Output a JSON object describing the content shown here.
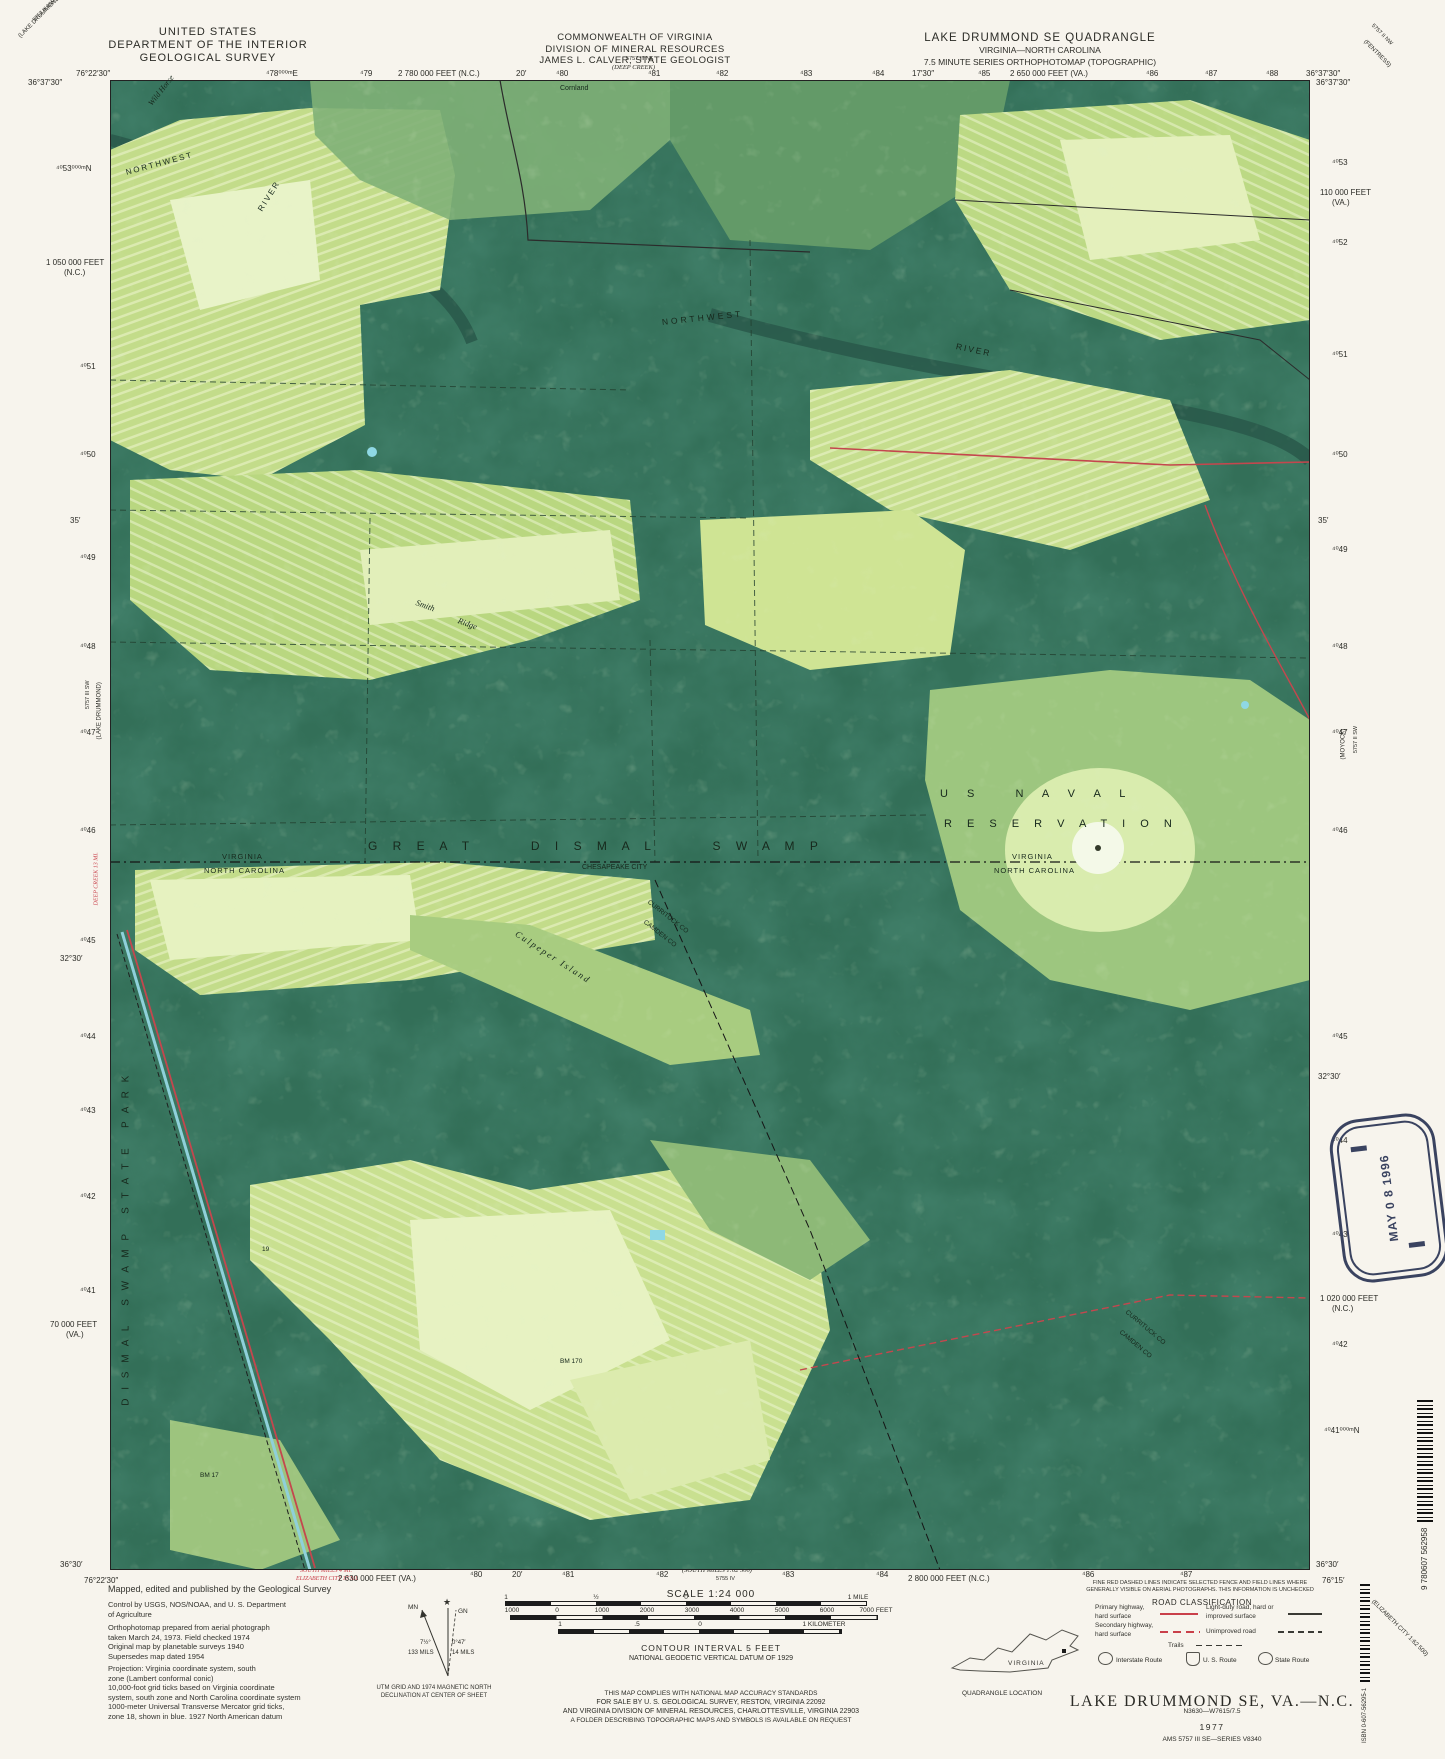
{
  "header": {
    "agency_lines": [
      "UNITED STATES",
      "DEPARTMENT OF THE INTERIOR",
      "GEOLOGICAL SURVEY"
    ],
    "state_lines": [
      "COMMONWEALTH OF VIRGINIA",
      "DIVISION OF MINERAL RESOURCES",
      "JAMES L. CALVER, STATE GEOLOGIST"
    ],
    "quad_lines": [
      "LAKE DRUMMOND SE QUADRANGLE",
      "VIRGINIA—NORTH CAROLINA",
      "7.5 MINUTE SERIES ORTHOPHOTOMAP (TOPOGRAPHIC)"
    ]
  },
  "margin_ticks": {
    "top": [
      {
        "t": "76°22′30″",
        "x": 76,
        "y": 69
      },
      {
        "t": "⁴78⁰⁰⁰ᵐE",
        "x": 266,
        "y": 69
      },
      {
        "t": "⁴79",
        "x": 360,
        "y": 69
      },
      {
        "t": "2 780 000 FEET (N.C.)",
        "x": 398,
        "y": 69
      },
      {
        "t": "20′",
        "x": 516,
        "y": 69
      },
      {
        "t": "⁴80",
        "x": 556,
        "y": 69
      },
      {
        "t": "⁴81",
        "x": 648,
        "y": 69
      },
      {
        "t": "⁴82",
        "x": 716,
        "y": 69
      },
      {
        "t": "⁴83",
        "x": 800,
        "y": 69
      },
      {
        "t": "⁴84",
        "x": 872,
        "y": 69
      },
      {
        "t": "17′30″",
        "x": 912,
        "y": 69
      },
      {
        "t": "⁴85",
        "x": 978,
        "y": 69
      },
      {
        "t": "2 650 000 FEET (VA.)",
        "x": 1010,
        "y": 69
      },
      {
        "t": "⁴86",
        "x": 1146,
        "y": 69
      },
      {
        "t": "⁴87",
        "x": 1205,
        "y": 69
      },
      {
        "t": "⁴88",
        "x": 1266,
        "y": 69
      },
      {
        "t": "36°37′30″",
        "x": 1306,
        "y": 69
      }
    ],
    "left": [
      {
        "t": "36°37′30″",
        "x": 28,
        "y": 78
      },
      {
        "t": "⁴⁰53⁰⁰⁰ᵐN",
        "x": 56,
        "y": 164
      },
      {
        "t": "1 050 000 FEET",
        "x": 46,
        "y": 258
      },
      {
        "t": "(N.C.)",
        "x": 64,
        "y": 268
      },
      {
        "t": "⁴⁰51",
        "x": 80,
        "y": 362
      },
      {
        "t": "⁴⁰50",
        "x": 80,
        "y": 450
      },
      {
        "t": "35′",
        "x": 70,
        "y": 516
      },
      {
        "t": "⁴⁰49",
        "x": 80,
        "y": 553
      },
      {
        "t": "⁴⁰48",
        "x": 80,
        "y": 642
      },
      {
        "t": "⁴⁰47",
        "x": 80,
        "y": 728
      },
      {
        "t": "⁴⁰46",
        "x": 80,
        "y": 826
      },
      {
        "t": "⁴⁰45",
        "x": 80,
        "y": 936
      },
      {
        "t": "32°30′",
        "x": 60,
        "y": 954
      },
      {
        "t": "⁴⁰44",
        "x": 80,
        "y": 1032
      },
      {
        "t": "⁴⁰43",
        "x": 80,
        "y": 1106
      },
      {
        "t": "⁴⁰42",
        "x": 80,
        "y": 1192
      },
      {
        "t": "⁴⁰41",
        "x": 80,
        "y": 1286
      },
      {
        "t": "70 000 FEET",
        "x": 50,
        "y": 1320
      },
      {
        "t": "(VA.)",
        "x": 66,
        "y": 1330
      },
      {
        "t": "36°30′",
        "x": 60,
        "y": 1560
      }
    ],
    "right": [
      {
        "t": "36°37′30″",
        "x": 1316,
        "y": 78
      },
      {
        "t": "⁴⁰53",
        "x": 1332,
        "y": 158
      },
      {
        "t": "110 000 FEET",
        "x": 1320,
        "y": 188
      },
      {
        "t": "(VA.)",
        "x": 1332,
        "y": 198
      },
      {
        "t": "⁴⁰52",
        "x": 1332,
        "y": 238
      },
      {
        "t": "⁴⁰51",
        "x": 1332,
        "y": 350
      },
      {
        "t": "⁴⁰50",
        "x": 1332,
        "y": 450
      },
      {
        "t": "35′",
        "x": 1318,
        "y": 516
      },
      {
        "t": "⁴⁰49",
        "x": 1332,
        "y": 545
      },
      {
        "t": "⁴⁰48",
        "x": 1332,
        "y": 642
      },
      {
        "t": "⁴⁰47",
        "x": 1332,
        "y": 728
      },
      {
        "t": "⁴⁰46",
        "x": 1332,
        "y": 826
      },
      {
        "t": "⁴⁰45",
        "x": 1332,
        "y": 1032
      },
      {
        "t": "32°30′",
        "x": 1318,
        "y": 1072
      },
      {
        "t": "⁴⁰44",
        "x": 1332,
        "y": 1136
      },
      {
        "t": "⁴⁰43",
        "x": 1332,
        "y": 1230
      },
      {
        "t": "1 020 000 FEET",
        "x": 1320,
        "y": 1294
      },
      {
        "t": "(N.C.)",
        "x": 1332,
        "y": 1304
      },
      {
        "t": "⁴⁰42",
        "x": 1332,
        "y": 1340
      },
      {
        "t": "⁴⁰41⁰⁰⁰ᵐN",
        "x": 1324,
        "y": 1426
      },
      {
        "t": "36°30′",
        "x": 1316,
        "y": 1560
      }
    ],
    "bottom": [
      {
        "t": "76°22′30″",
        "x": 84,
        "y": 1576
      },
      {
        "t": "SOUTH MILLS 4 MI.",
        "x": 300,
        "y": 1568,
        "cls": "red ital",
        "size": 6
      },
      {
        "t": "ELIZABETH CITY 17 MI.",
        "x": 296,
        "y": 1576,
        "cls": "red ital",
        "size": 6
      },
      {
        "t": "2 630 000 FEET (VA.)",
        "x": 338,
        "y": 1574
      },
      {
        "t": "⁴80",
        "x": 470,
        "y": 1570
      },
      {
        "t": "20′",
        "x": 512,
        "y": 1570
      },
      {
        "t": "⁴81",
        "x": 562,
        "y": 1570
      },
      {
        "t": "⁴82",
        "x": 656,
        "y": 1570
      },
      {
        "t": "(SOUTH MILLS 1:62 500)",
        "x": 682,
        "y": 1567,
        "cls": "ital",
        "size": 6.5
      },
      {
        "t": "5755 IV",
        "x": 716,
        "y": 1576,
        "size": 5.5
      },
      {
        "t": "⁴83",
        "x": 782,
        "y": 1570
      },
      {
        "t": "⁴84",
        "x": 876,
        "y": 1570
      },
      {
        "t": "2 800 000 FEET (N.C.)",
        "x": 908,
        "y": 1574
      },
      {
        "t": "⁴86",
        "x": 1082,
        "y": 1570
      },
      {
        "t": "⁴87",
        "x": 1180,
        "y": 1570
      },
      {
        "t": "76°15′",
        "x": 1322,
        "y": 1576
      }
    ],
    "misc": [
      {
        "t": "DEEP CREEK 13 MI.",
        "x": 97,
        "y": 902,
        "rot": -90,
        "cls": "red ital",
        "size": 6
      },
      {
        "t": "5757 III NW",
        "x": 34,
        "y": 18,
        "rot": -45,
        "size": 5.5
      },
      {
        "t": "(LAKE DRUMMOND NW)",
        "x": 20,
        "y": 34,
        "rot": -45,
        "size": 6
      },
      {
        "t": "5757 II NW",
        "x": 1372,
        "y": 22,
        "rot": 45,
        "size": 5.5
      },
      {
        "t": "(FENTRESS)",
        "x": 1364,
        "y": 38,
        "rot": 45,
        "size": 6
      },
      {
        "t": "5757 III SW",
        "x": 88,
        "y": 706,
        "rot": -90,
        "size": 5.5
      },
      {
        "t": "(LAKE DRUMMOND)",
        "x": 100,
        "y": 736,
        "rot": -90,
        "size": 6
      },
      {
        "t": "(MOYOCK)",
        "x": 1344,
        "y": 756,
        "rot": -90,
        "size": 6
      },
      {
        "t": "5757 II SW",
        "x": 1356,
        "y": 750,
        "rot": -90,
        "size": 5.5
      },
      {
        "t": "(ELIZABETH CITY 1:62 500)",
        "x": 1372,
        "y": 1598,
        "rot": 45,
        "size": 6
      },
      {
        "t": "5757 III NE",
        "x": 626,
        "y": 56,
        "size": 5.5
      },
      {
        "t": "(DEEP CREEK)",
        "x": 612,
        "y": 64,
        "cls": "ital",
        "size": 6.5
      }
    ]
  },
  "map": {
    "labels": [
      {
        "t": "Wild Horse",
        "x": 150,
        "y": 100,
        "rot": -52,
        "cls": "ital map-label",
        "size": 8
      },
      {
        "t": "Cornland",
        "x": 560,
        "y": 85,
        "cls": "map-label",
        "size": 7
      },
      {
        "t": "NORTHWEST",
        "x": 126,
        "y": 168,
        "rot": -15,
        "ls": 2,
        "cls": "map-label",
        "size": 8
      },
      {
        "t": "RIVER",
        "x": 260,
        "y": 206,
        "rot": -58,
        "ls": 2,
        "cls": "map-label",
        "size": 8
      },
      {
        "t": "NORTHWEST",
        "x": 662,
        "y": 318,
        "rot": -6,
        "ls": 3,
        "cls": "map-label",
        "size": 8.5
      },
      {
        "t": "RIVER",
        "x": 956,
        "y": 342,
        "rot": 12,
        "ls": 2,
        "cls": "map-label",
        "size": 8.5
      },
      {
        "t": "Smith",
        "x": 416,
        "y": 598,
        "rot": 20,
        "cls": "ital map-label",
        "size": 8.5
      },
      {
        "t": "Ridge",
        "x": 458,
        "y": 616,
        "rot": 20,
        "cls": "ital map-label",
        "size": 8.5
      },
      {
        "t": "G R E A T      D I S M A L      S W A M P",
        "x": 368,
        "y": 840,
        "ls": 6,
        "cls": "map-label",
        "size": 12
      },
      {
        "t": "VIRGINIA",
        "x": 222,
        "y": 853,
        "ls": 1,
        "cls": "map-label",
        "size": 7.5
      },
      {
        "t": "NORTH CAROLINA",
        "x": 204,
        "y": 867,
        "ls": 1,
        "cls": "map-label",
        "size": 7.5
      },
      {
        "t": "CHESAPEAKE CITY",
        "x": 582,
        "y": 864,
        "cls": "map-label",
        "size": 7
      },
      {
        "t": "VIRGINIA",
        "x": 1012,
        "y": 853,
        "ls": 1,
        "cls": "map-label",
        "size": 7.5
      },
      {
        "t": "NORTH CAROLINA",
        "x": 994,
        "y": 867,
        "ls": 1,
        "cls": "map-label",
        "size": 7.5
      },
      {
        "t": "CURRITUCK CO",
        "x": 648,
        "y": 898,
        "rot": 38,
        "cls": "map-label",
        "size": 6.5
      },
      {
        "t": "CAMDEN CO",
        "x": 644,
        "y": 918,
        "rot": 38,
        "cls": "map-label",
        "size": 6.5
      },
      {
        "t": "Culpeper Island",
        "x": 516,
        "y": 928,
        "rot": 33,
        "ls": 2,
        "cls": "ital map-label",
        "size": 9
      },
      {
        "t": "U S   N A V A L",
        "x": 940,
        "y": 788,
        "ls": 8,
        "cls": "map-label",
        "size": 11
      },
      {
        "t": "R E S E R V A T I O N",
        "x": 944,
        "y": 818,
        "ls": 6,
        "cls": "map-label",
        "size": 11
      },
      {
        "t": "D I S M A L   S W A M P   S T A T E   P A R K",
        "x": 126,
        "y": 1400,
        "rot": -90,
        "ls": 3,
        "cls": "map-label",
        "size": 10
      },
      {
        "t": "CURRITUCK CO",
        "x": 1126,
        "y": 1308,
        "rot": 40,
        "cls": "map-label",
        "size": 6.5
      },
      {
        "t": "CAMDEN CO",
        "x": 1120,
        "y": 1328,
        "rot": 40,
        "cls": "map-label",
        "size": 6.5
      },
      {
        "t": "BM 170",
        "x": 560,
        "y": 1358,
        "cls": "map-label",
        "size": 6.5
      },
      {
        "t": "BM 17",
        "x": 200,
        "y": 1472,
        "cls": "map-label",
        "size": 6.5
      },
      {
        "t": "19",
        "x": 262,
        "y": 1246,
        "cls": "map-label",
        "size": 6.5
      }
    ]
  },
  "footer": {
    "credits": {
      "p1": "Mapped, edited and published by the Geological Survey",
      "p2": "Control by USGS, NOS/NOAA, and U. S. Department\nof Agriculture",
      "p3": "Orthophotomap prepared from aerial photograph\ntaken March 24, 1973.   Field checked 1974\nOriginal map by planetable surveys 1940\nSupersedes map dated 1954",
      "p4": "Projection: Virginia coordinate system, south\nzone (Lambert conformal conic)\n10,000-foot grid ticks based on Virginia coordinate\nsystem, south zone and North Carolina coordinate system\n1000-meter Universal Transverse Mercator grid ticks,\nzone 18, shown in blue.   1927 North American datum"
    },
    "scale_label": "SCALE 1:24 000",
    "bar_labels": [
      {
        "t": "1",
        "x": 506,
        "y": 1594,
        "ctr": 1,
        "size": 6.5
      },
      {
        "t": "½",
        "x": 596,
        "y": 1594,
        "ctr": 1,
        "size": 6.5
      },
      {
        "t": "0",
        "x": 686,
        "y": 1594,
        "ctr": 1,
        "size": 6.5
      },
      {
        "t": "1 MILE",
        "x": 858,
        "y": 1594,
        "ctr": 1,
        "size": 6.5
      },
      {
        "t": "1000",
        "x": 512,
        "y": 1607,
        "ctr": 1,
        "size": 6.5
      },
      {
        "t": "0",
        "x": 557,
        "y": 1607,
        "ctr": 1,
        "size": 6.5
      },
      {
        "t": "1000",
        "x": 602,
        "y": 1607,
        "ctr": 1,
        "size": 6.5
      },
      {
        "t": "2000",
        "x": 647,
        "y": 1607,
        "ctr": 1,
        "size": 6.5
      },
      {
        "t": "3000",
        "x": 692,
        "y": 1607,
        "ctr": 1,
        "size": 6.5
      },
      {
        "t": "4000",
        "x": 737,
        "y": 1607,
        "ctr": 1,
        "size": 6.5
      },
      {
        "t": "5000",
        "x": 782,
        "y": 1607,
        "ctr": 1,
        "size": 6.5
      },
      {
        "t": "6000",
        "x": 827,
        "y": 1607,
        "ctr": 1,
        "size": 6.5
      },
      {
        "t": "7000 FEET",
        "x": 876,
        "y": 1607,
        "ctr": 1,
        "size": 6.5
      },
      {
        "t": "1",
        "x": 560,
        "y": 1621,
        "ctr": 1,
        "size": 6.5
      },
      {
        "t": ".5",
        "x": 637,
        "y": 1621,
        "ctr": 1,
        "size": 6.5
      },
      {
        "t": "0",
        "x": 700,
        "y": 1621,
        "ctr": 1,
        "size": 6.5
      },
      {
        "t": "1 KILOMETER",
        "x": 824,
        "y": 1621,
        "ctr": 1,
        "size": 6.5
      }
    ],
    "contour": "CONTOUR INTERVAL 5 FEET",
    "datum": "NATIONAL GEODETIC VERTICAL DATUM OF 1929",
    "accuracy": [
      "THIS MAP COMPLIES WITH NATIONAL MAP ACCURACY STANDARDS",
      "FOR SALE BY U. S. GEOLOGICAL SURVEY, RESTON, VIRGINIA 22092",
      "AND VIRGINIA DIVISION OF MINERAL RESOURCES, CHARLOTTESVILLE, VIRGINIA 22903",
      "A FOLDER DESCRIBING TOPOGRAPHIC MAPS AND SYMBOLS IS AVAILABLE ON REQUEST"
    ],
    "declination": {
      "mn": "MN",
      "gn": "GN",
      "deg1": "7½°",
      "mils1": "133 MILS",
      "deg2": "0°47′",
      "mils2": "14 MILS",
      "caption": "UTM GRID AND 1974 MAGNETIC NORTH\nDECLINATION AT CENTER OF SHEET"
    },
    "quad_location": {
      "state": "VIRGINIA",
      "caption": "QUADRANGLE LOCATION"
    },
    "fence_note": "FINE RED DASHED LINES INDICATE SELECTED FENCE AND FIELD LINES WHERE\nGENERALLY VISIBLE ON AERIAL PHOTOGRAPHS. THIS INFORMATION IS UNCHECKED",
    "road_class": {
      "title": "ROAD CLASSIFICATION",
      "r1": "Primary highway,\nhard surface",
      "r2": "Light-duty road, hard or\nimproved surface",
      "r3": "Secondary highway,\nhard surface",
      "r4": "Unimproved road",
      "trails": "Trails",
      "interstate": "Interstate Route",
      "us": "U. S. Route",
      "state": "State Route"
    },
    "title_block": {
      "title": "LAKE DRUMMOND SE, VA.—N.C.",
      "id": "N3630—W7615/7.5",
      "year": "1977",
      "series": "AMS 5757 III SE—SERIES V8340"
    }
  },
  "stamp": {
    "date": "MAY 0 8 1996"
  },
  "codes": {
    "isbn": "ISBN 0-607-56295-1",
    "ean": "9 780607 562958"
  }
}
